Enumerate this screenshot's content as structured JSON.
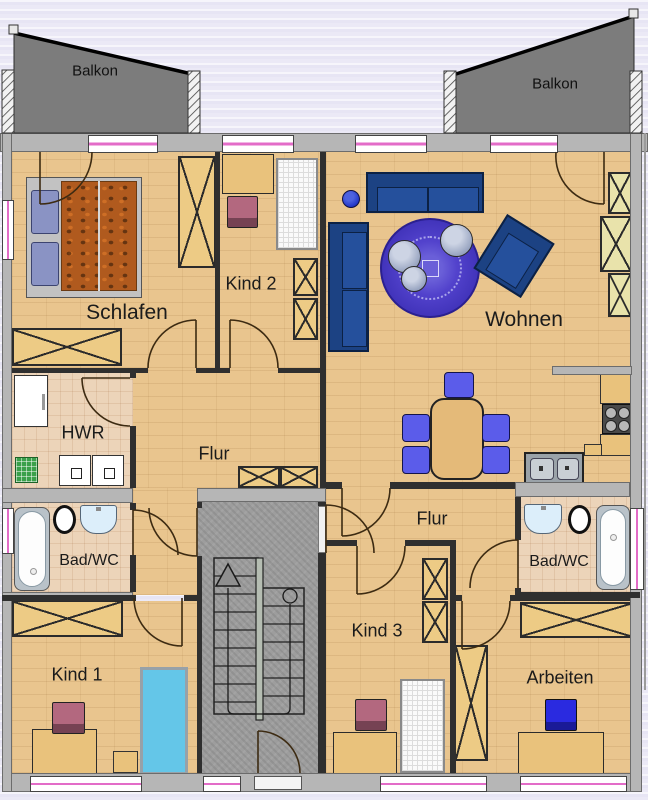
{
  "type": "apartment-floor-plan",
  "rooms": {
    "balkon_left": {
      "label": "Balkon"
    },
    "balkon_right": {
      "label": "Balkon"
    },
    "schlafen": {
      "label": "Schlafen"
    },
    "kind2": {
      "label": "Kind 2"
    },
    "wohnen": {
      "label": "Wohnen"
    },
    "hwr": {
      "label": "HWR"
    },
    "flur_left": {
      "label": "Flur"
    },
    "bad_left": {
      "label": "Bad/WC"
    },
    "kind1": {
      "label": "Kind 1"
    },
    "flur_right": {
      "label": "Flur"
    },
    "bad_right": {
      "label": "Bad/WC"
    },
    "kind3": {
      "label": "Kind 3"
    },
    "arbeiten": {
      "label": "Arbeiten"
    }
  },
  "colors": {
    "wall_gray": "#b6b6b6",
    "interior_wall": "#2f2f2f",
    "balcony_gray": "#7c7c7c",
    "wood_floor": "#e9c58e",
    "tile_floor": "#ecd4b9",
    "stairwell_concrete": "#9d9d9d",
    "sofa_blue": "#1c4283",
    "rug_purple": "#4a38c4",
    "dining_chair_blue": "#5b5cea",
    "office_chair_blue": "#2a2ae0",
    "kids_chair_mauve": "#b3687f",
    "bed_cyan": "#64c6e8",
    "shelf_yellow": "#e9e3ab",
    "furniture_wood": "#edcb85",
    "window_accent": "#e36cc8",
    "duvet_orange": "#b05a1e",
    "mat_green": "#3aa04a"
  }
}
